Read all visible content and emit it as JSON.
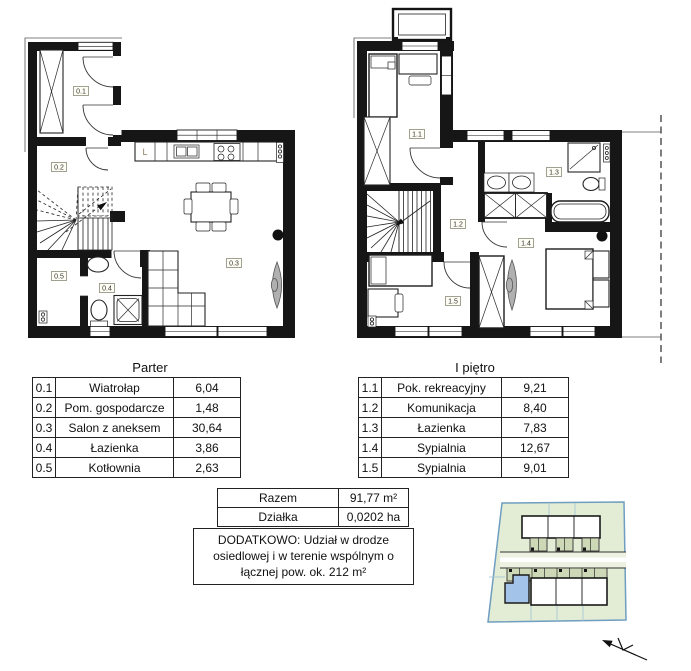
{
  "floor_plans": {
    "parter": {
      "title": "Parter",
      "rooms": [
        {
          "id": "0.1",
          "name": "Wiatrołap",
          "area": "6,04"
        },
        {
          "id": "0.2",
          "name": "Pom. gospodarcze",
          "area": "1,48"
        },
        {
          "id": "0.3",
          "name": "Salon z aneksem",
          "area": "30,64"
        },
        {
          "id": "0.4",
          "name": "Łazienka",
          "area": "3,86"
        },
        {
          "id": "0.5",
          "name": "Kotłownia",
          "area": "2,63"
        }
      ],
      "labels": {
        "kitchen_fridge": "L"
      }
    },
    "pietro": {
      "title": "I piętro",
      "rooms": [
        {
          "id": "1.1",
          "name": "Pok. rekreacyjny",
          "area": "9,21"
        },
        {
          "id": "1.2",
          "name": "Komunikacja",
          "area": "8,40"
        },
        {
          "id": "1.3",
          "name": "Łazienka",
          "area": "7,83"
        },
        {
          "id": "1.4",
          "name": "Sypialnia",
          "area": "12,67"
        },
        {
          "id": "1.5",
          "name": "Sypialnia",
          "area": "9,01"
        }
      ]
    }
  },
  "summary": {
    "rows": [
      {
        "label": "Razem",
        "value": "91,77 m²"
      },
      {
        "label": "Działka",
        "value": "0,0202 ha"
      }
    ],
    "note": "DODATKOWO: Udział w drodze osiedlowej i w terenie wspólnym o łącznej pow. ok. 212 m²"
  },
  "site_plan": {
    "colors": {
      "site_fill": "#e3ecd4",
      "boundary": "#6f9ec0",
      "parcel_line": "#a9c8da",
      "annex_fill": "#cdd9b6",
      "road_fill": "#edf1e1",
      "house_fill": "#ffffff",
      "highlight_unit": "#a4c3e8"
    }
  }
}
